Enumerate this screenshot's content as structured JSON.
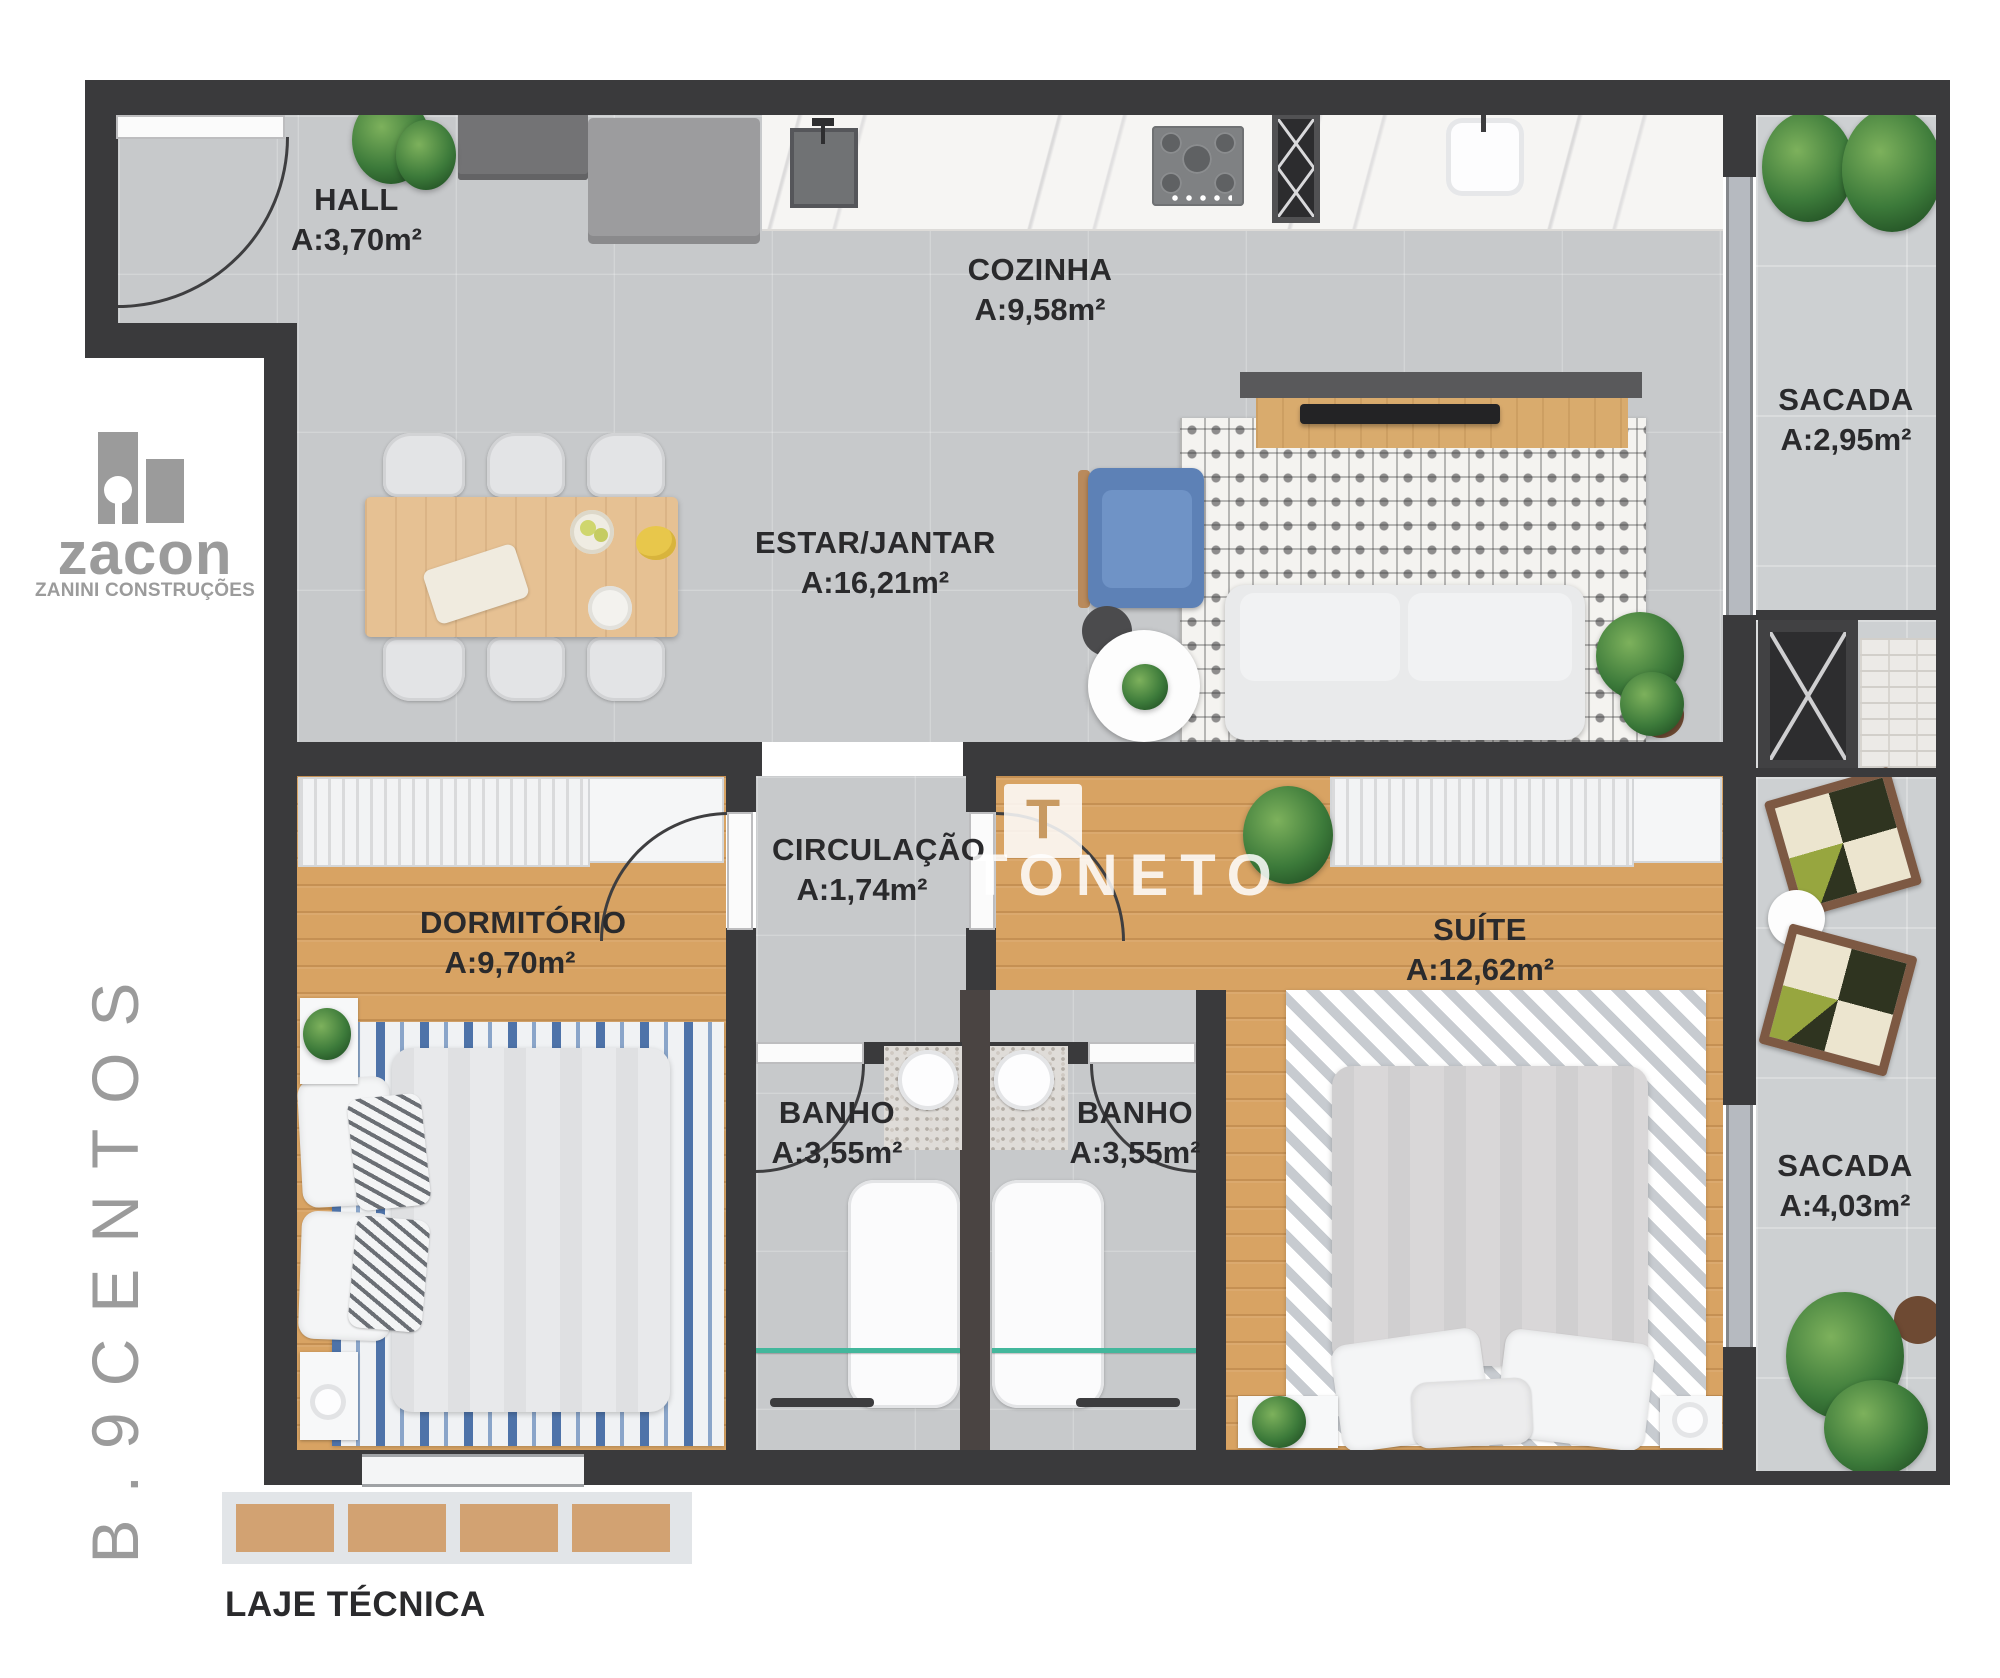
{
  "branding": {
    "logo_word": "zacon",
    "logo_subtitle": "ZANINI CONSTRUÇÕES",
    "vertical_building_name": "B.9CENTOS",
    "watermark_text": "TONETO",
    "watermark_letter": "T"
  },
  "rooms": {
    "hall": {
      "name": "HALL",
      "area": "A:3,70m²"
    },
    "cozinha": {
      "name": "COZINHA",
      "area": "A:9,58m²"
    },
    "sacada_superior": {
      "name": "SACADA",
      "area": "A:2,95m²"
    },
    "estar_jantar": {
      "name": "ESTAR/JANTAR",
      "area": "A:16,21m²"
    },
    "circulacao": {
      "name": "CIRCULAÇÃO",
      "area": "A:1,74m²"
    },
    "dormitorio": {
      "name": "DORMITÓRIO",
      "area": "A:9,70m²"
    },
    "banho_esquerdo": {
      "name": "BANHO",
      "area": "A:3,55m²"
    },
    "banho_direito": {
      "name": "BANHO",
      "area": "A:3,55m²"
    },
    "suite": {
      "name": "SUÍTE",
      "area": "A:12,62m²"
    },
    "sacada_inferior": {
      "name": "SACADA",
      "area": "A:4,03m²"
    },
    "laje_tecnica": {
      "name": "LAJE TÉCNICA"
    }
  },
  "colors": {
    "wall": "#3a3a3c",
    "tile": "#c7c9cb",
    "tile_light": "#cdd0d2",
    "wood": "#d8a363",
    "marble": "#f6f5f3",
    "brand_gray": "#9b9b9b",
    "text_dark": "#2a2a2c",
    "armchair_blue": "#5d81b6",
    "shower_glass_teal": "#43b79c",
    "laje_tan": "#d2a272"
  }
}
